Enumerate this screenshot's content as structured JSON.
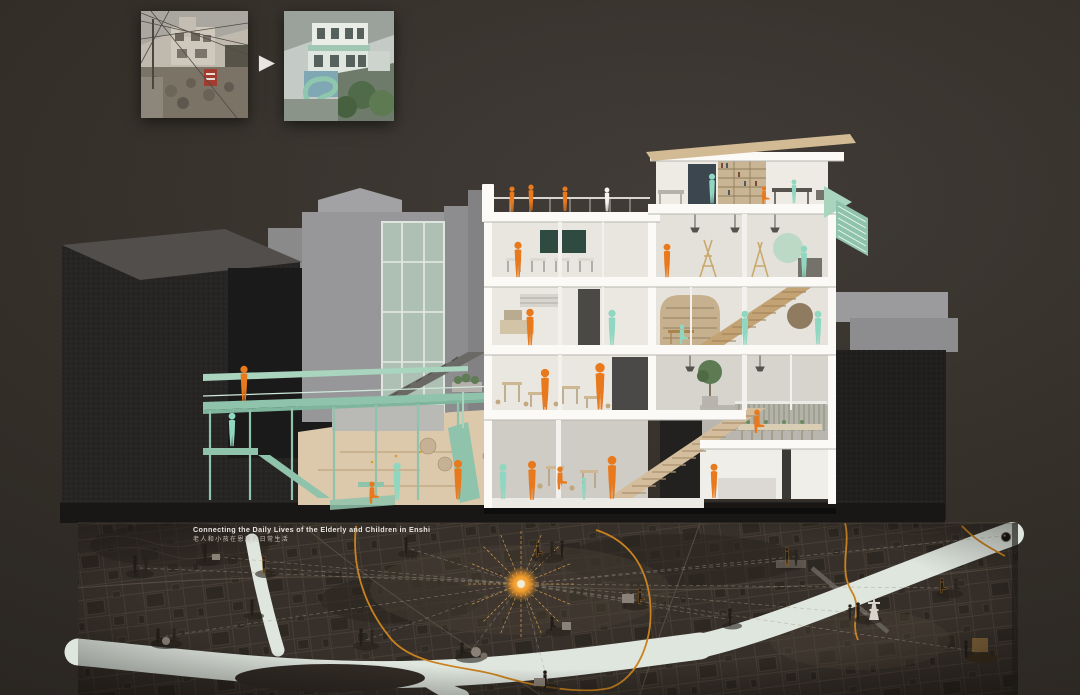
{
  "transformation": {
    "arrow_icon": "▶"
  },
  "map": {
    "title": "Connecting the Daily Lives of the Elderly and Children in Enshi",
    "subtitle": "老人和小孩在恩施的日常生活"
  },
  "icons": {
    "transform_arrow": "▶",
    "map_pin": "●",
    "site_marker": "✹"
  },
  "palette": {
    "bg": "#322e2b",
    "orange": "#e8791d",
    "teal": "#8fd7c0",
    "mint": "#a9d4bd",
    "mint-dark": "#8fc3ab",
    "wood": "#c3a274",
    "tan": "#d5c0a0",
    "river": "#dfe6de",
    "map-base": "#37302a",
    "map-orange": "#c9821f",
    "sun": "#f09a2a",
    "title": "#e9e5de"
  }
}
